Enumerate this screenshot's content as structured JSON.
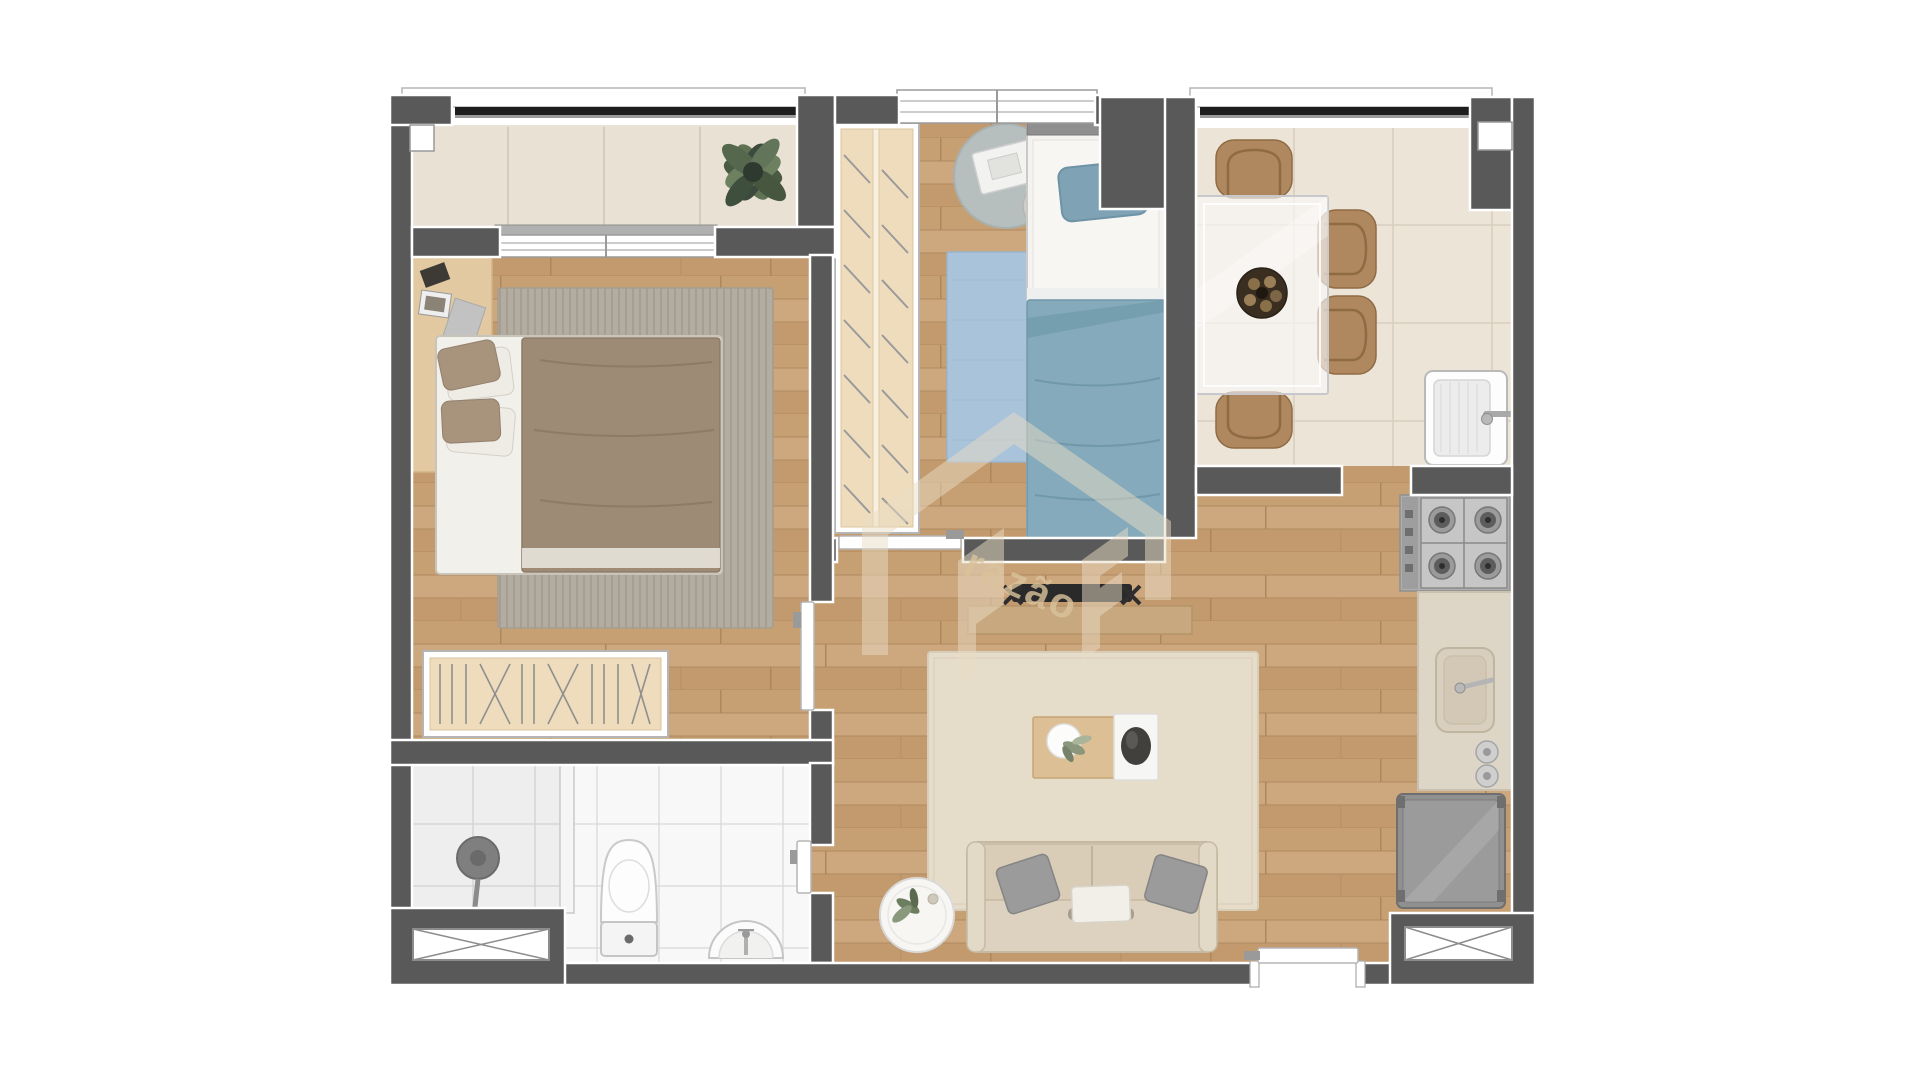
{
  "watermark": {
    "text": "razão",
    "color": "#d9c39c",
    "shape_color": "#e9dcc4"
  },
  "palette": {
    "background": "#ffffff",
    "wall": "#595959",
    "wall_trim": "#ffffff",
    "wood_floor": "#c69e74",
    "balcony_floor": "#e9e1d3",
    "dining_tile": "#ece4d7",
    "bath_tile": "#f8f8f8",
    "bedroom_rug": "#b3aca1",
    "blue_rug": "#a9c3da",
    "blue_textile": "#84aabb",
    "living_rug": "#e6dcca",
    "sofa": "#ddd2bf",
    "chair_tan": "#b0885f",
    "wardrobe_interior": "#eedcbc",
    "appliance_gray": "#8d8d8d",
    "railing_black": "#1d1d1d"
  },
  "floor_plan": {
    "type": "apartment-top-view-render",
    "dining_chairs": 4,
    "stove_burners": 4,
    "rooms": [
      {
        "name": "balcony",
        "furniture": [
          "potted-plant"
        ]
      },
      {
        "name": "bedroom-1",
        "furniture": [
          "double-bed",
          "striped-rug",
          "headboard-shelf",
          "open-hanger-rack",
          "door"
        ]
      },
      {
        "name": "bedroom-2",
        "furniture": [
          "wardrobe-with-hangers",
          "single-bed-blue",
          "blue-rug",
          "round-rug",
          "desk",
          "stool",
          "sliding-door"
        ]
      },
      {
        "name": "dining-room",
        "furniture": [
          "glass-table",
          "four-chairs",
          "fruit-bowl"
        ]
      },
      {
        "name": "laundry",
        "furniture": [
          "wash-tub",
          "faucet"
        ]
      },
      {
        "name": "kitchen",
        "furniture": [
          "gas-cooktop",
          "counter-with-sink",
          "refrigerator"
        ]
      },
      {
        "name": "living-room",
        "furniture": [
          "sofa",
          "coffee-table",
          "tv",
          "tv-console",
          "round-side-table",
          "plant",
          "rug",
          "entry-door"
        ]
      },
      {
        "name": "bathroom",
        "furniture": [
          "shower",
          "toilet",
          "pedestal-sink",
          "door",
          "vent-shaft"
        ]
      }
    ],
    "vent_shafts": 2
  }
}
